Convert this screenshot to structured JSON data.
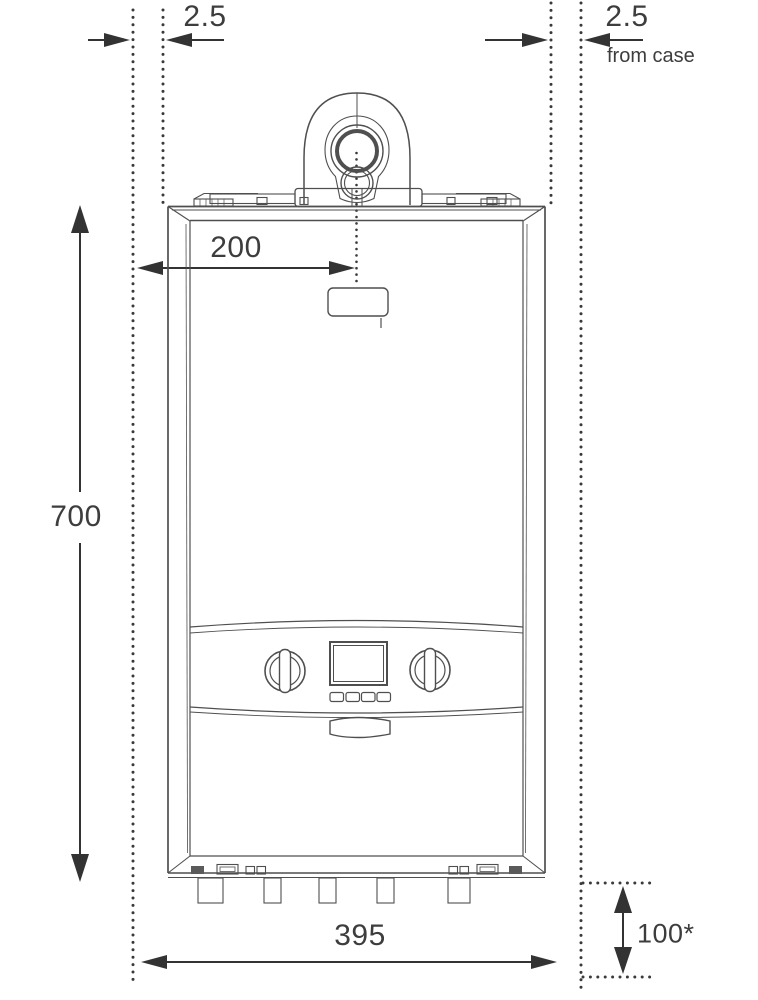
{
  "drawing": {
    "subject": "wall-mounted boiler front elevation with installation clearances"
  },
  "colors": {
    "background": "#ffffff",
    "artwork_line": "#4f4f4f",
    "dimension_line": "#333333",
    "label_text": "#3d3d3d"
  },
  "dimensions": {
    "left_clearance": {
      "value": "2.5"
    },
    "right_clearance": {
      "value": "2.5",
      "note": "from case"
    },
    "height": {
      "value": "700"
    },
    "flue_offset": {
      "value": "200"
    },
    "width": {
      "value": "395"
    },
    "bottom_clearance": {
      "value": "100*"
    }
  }
}
